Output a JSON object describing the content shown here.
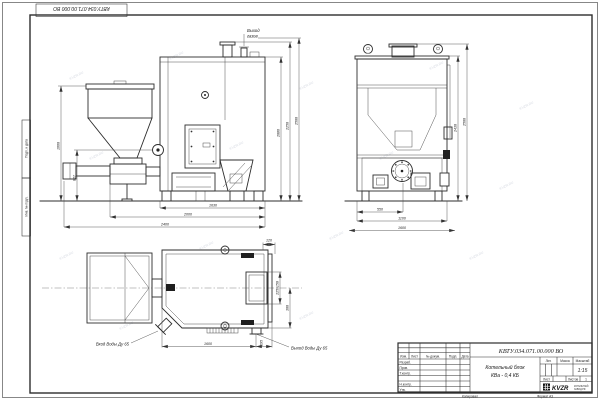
{
  "sheet": {
    "stamp_number": "КВТУ.034.071.00.000 ВО",
    "margin_label_1": "Подп. и дата",
    "margin_label_2": "Инв. № подл.",
    "footer_copy": "Копировал",
    "footer_format": "Формат А3",
    "watermark": "KVZR.RU"
  },
  "callouts": {
    "gas_line1": "Выход",
    "gas_line2": "газов",
    "water_inlet": "Вход Воды Ду 65",
    "water_outlet": "Выход Воды Ду 65"
  },
  "dims": {
    "front": {
      "hopper_height": "1660",
      "burner_axis": "827",
      "body_height": "2086",
      "chimney_height": "2250",
      "overall_height": "2500",
      "body_width": "1630",
      "feed_width": "2000",
      "overall_width": "2400"
    },
    "side": {
      "frame_height": "2430",
      "overall_height": "2500",
      "burner_offset": "550",
      "body_width": "1100",
      "overall_width": "1600"
    },
    "plan": {
      "body_length": "1600",
      "outlet_offset": "195",
      "door_opening": "225x150",
      "outlet_spacing": "300",
      "wall_offset": "120"
    }
  },
  "title_block": {
    "doc_number": "КВТУ.034.071.00.000 ВО",
    "product_line1": "Котельный блок",
    "product_line2": "КВа - 0,4 КБ",
    "col_izm": "Изм.",
    "col_list": "Лист",
    "col_doc": "№ докум.",
    "col_sign": "Подп.",
    "col_date": "Дата",
    "row_developed": "Разраб.",
    "row_checked": "Пров.",
    "row_tcontrol": "Т.контр.",
    "row_ncontrol": "Н.контр.",
    "row_approved": "Утв.",
    "lit_label": "Лит.",
    "mass_label": "Масса",
    "scale_label": "Масштаб",
    "scale_value": "1:15",
    "sheet_label": "Лист",
    "sheets_label": "Листов",
    "sheets_value": "1",
    "logo_text": "KVZR",
    "logo_sub1": "КОТЕЛЬНЫЙ",
    "logo_sub2": "ЗАВОД.РФ"
  }
}
